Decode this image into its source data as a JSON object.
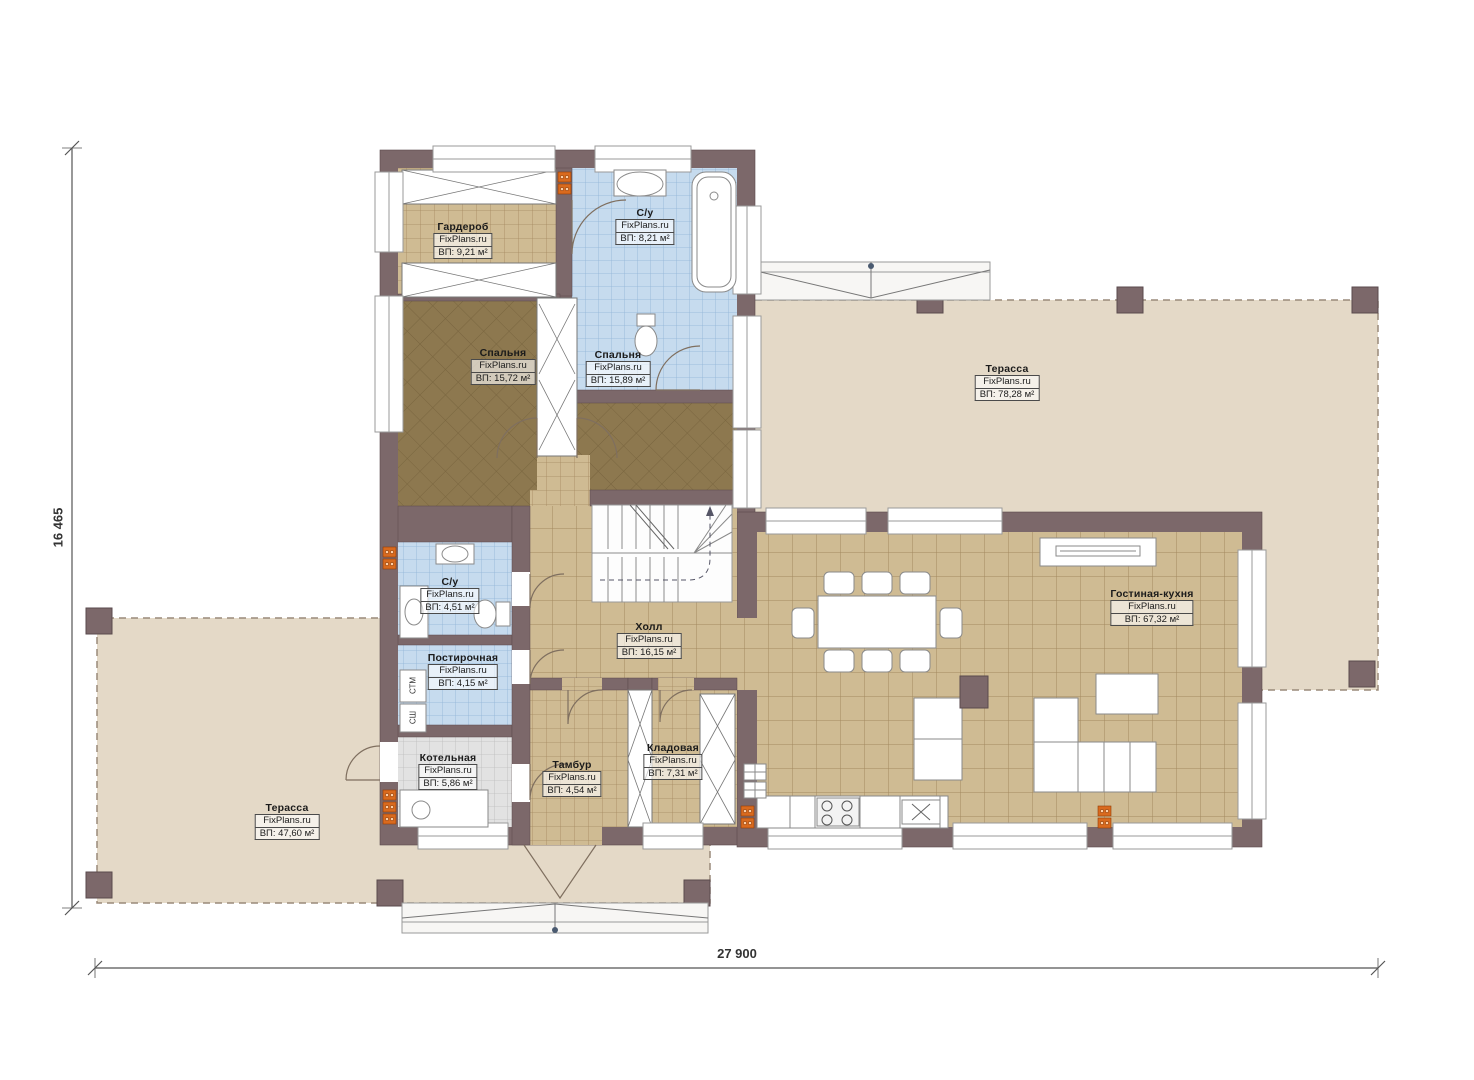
{
  "plan": {
    "brand": "FixPlans.ru",
    "dimensions": {
      "height_label": "16 465",
      "width_label": "27 900"
    },
    "rooms": [
      {
        "name": "Гардероб",
        "area": "ВП: 9,21 м²"
      },
      {
        "name": "С/у",
        "area": "ВП: 8,21 м²"
      },
      {
        "name": "Спальня",
        "area": "ВП: 15,72 м²"
      },
      {
        "name": "Спальня",
        "area": "ВП: 15,89 м²"
      },
      {
        "name": "С/у",
        "area": "ВП: 4,51 м²"
      },
      {
        "name": "Постирочная",
        "area": "ВП: 4,15 м²"
      },
      {
        "name": "Котельная",
        "area": "ВП: 5,86 м²"
      },
      {
        "name": "Тамбур",
        "area": "ВП: 4,54 м²"
      },
      {
        "name": "Холл",
        "area": "ВП: 16,15 м²"
      },
      {
        "name": "Кладовая",
        "area": "ВП: 7,31 м²"
      },
      {
        "name": "Гостиная-кухня",
        "area": "ВП: 67,32 м²"
      },
      {
        "name": "Терасса",
        "area": "ВП: 78,28 м²"
      },
      {
        "name": "Терасса",
        "area": "ВП: 47,60 м²"
      }
    ],
    "appliance_labels": {
      "washer": "СТМ",
      "dryer": "СШ"
    },
    "colors": {
      "wall": "#7c686a",
      "tile_floor": "#cfbb93",
      "wood_floor": "#8d784f",
      "bath_tile": "#c6dbee",
      "boiler_floor": "#e2e2e2",
      "terrace": "#e4d9c7",
      "vent": "#d96a1e"
    }
  }
}
